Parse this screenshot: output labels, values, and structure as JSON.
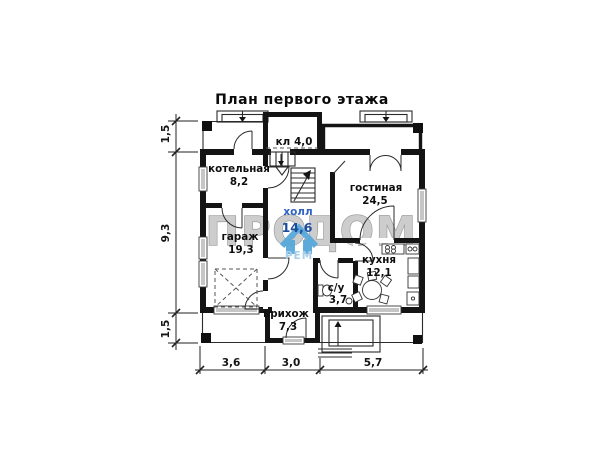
{
  "title": "План первого этажа",
  "rooms": {
    "closet": {
      "name": "кл",
      "area": "4,0"
    },
    "boiler": {
      "name": "котельная",
      "area": "8,2"
    },
    "living": {
      "name": "гостиная",
      "area": "24,5"
    },
    "hall": {
      "name": "холл",
      "area": "14,6"
    },
    "garage": {
      "name": "гараж",
      "area": "19,3"
    },
    "kitchen": {
      "name": "кухня",
      "area": "12,1"
    },
    "wc": {
      "name": "с/у",
      "area": "3,7"
    },
    "entry": {
      "name": "прихож",
      "area": "7,3"
    }
  },
  "dimensions": {
    "left_top": "1,5",
    "left_middle": "9,3",
    "left_bottom": "1,5",
    "bottom_left": "3,6",
    "bottom_center": "3,0",
    "bottom_right": "5,7"
  },
  "watermark": {
    "text_left": "ПРО",
    "text_right": "ДОМ",
    "text_sub": "РЕМ"
  },
  "colors": {
    "wall": "#141414",
    "watermark_fill": "#cdcdcd",
    "watermark_stroke": "#949494",
    "logo_blue": "#58a8da",
    "logo_light_blue": "#a6cde9",
    "hall_label_blue": "#2f62c5",
    "hall_area_blue": "#1c4d9d",
    "window_gray": "#c6c6c6"
  }
}
